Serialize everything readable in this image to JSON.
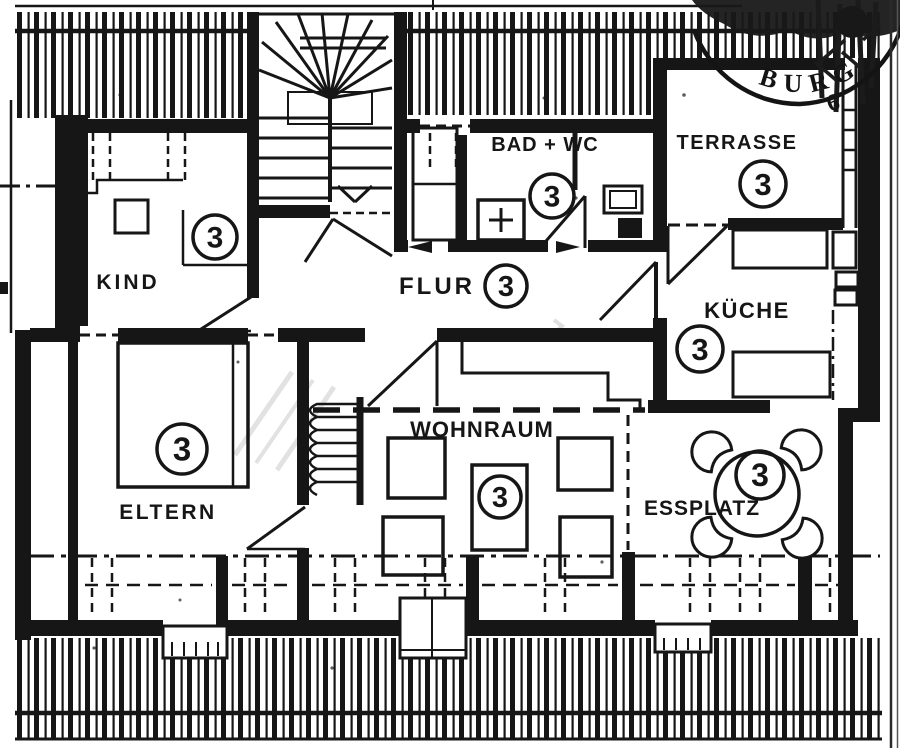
{
  "plan": {
    "paper_color": "#ffffff",
    "ink_color": "#161616",
    "rooms": [
      {
        "id": "kind",
        "label": "KIND",
        "number": "3"
      },
      {
        "id": "flur",
        "label": "FLUR",
        "number": "3"
      },
      {
        "id": "bad-wc",
        "label": "BAD + WC",
        "number": "3"
      },
      {
        "id": "terrasse",
        "label": "TERRASSE",
        "number": "3"
      },
      {
        "id": "kueche",
        "label": "KÜCHE",
        "number": "3"
      },
      {
        "id": "eltern",
        "label": "ELTERN",
        "number": "3"
      },
      {
        "id": "wohnraum",
        "label": "WOHNRAUM",
        "number": "3"
      },
      {
        "id": "essplatz",
        "label": "ESSPLATZ",
        "number": "3"
      }
    ],
    "stamp": {
      "arc_text": "BURG",
      "number": "6"
    }
  }
}
